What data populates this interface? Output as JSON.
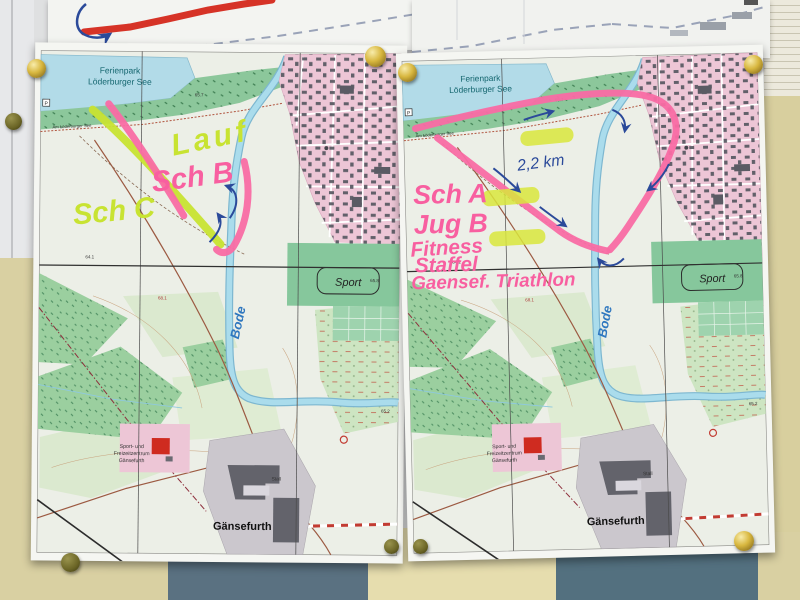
{
  "base_map": {
    "labels": {
      "ferienpark_line1": "Ferienpark",
      "ferienpark_line2": "Löderburger See",
      "lakeside_path": "Am Löderburger See",
      "parking": "P",
      "river": "Bode",
      "sport": "Sport",
      "center_line1": "Sport- und",
      "center_line2": "Freizeitzentrum",
      "center_line3": "Gänsefurth",
      "stall": "Stall",
      "town": "Gänsefurth",
      "spot_heights": {
        "h1": "65.7",
        "h2": "64.1",
        "h3": "68.1",
        "h4": "65.8",
        "h5": "65.2"
      }
    }
  },
  "left_map": {
    "annotations": {
      "lauf": "Lauf",
      "sch_b": "Sch B",
      "sch_c": "Sch C"
    }
  },
  "right_map": {
    "annotations": {
      "sch_a": "Sch A",
      "jug_b": "Jug B",
      "fitness": "Fitness",
      "staffel": "Staffel",
      "event": "Gaensef. Triathlon",
      "distance": "2,2 km"
    }
  },
  "colors": {
    "route_pink": "#f96ba4",
    "highlighter_green": "#c8e332",
    "highlighter_yellow": "#d9e63c",
    "pen_blue": "#2b4a9a",
    "handwriting_pink": "#f85fa0",
    "map_water": "#aadcec",
    "map_town_pink": "#edc6d6",
    "wall_tan": "#d9d0a2",
    "wall_slate": "#5a7181",
    "pin_gold": "#d8b73f"
  }
}
